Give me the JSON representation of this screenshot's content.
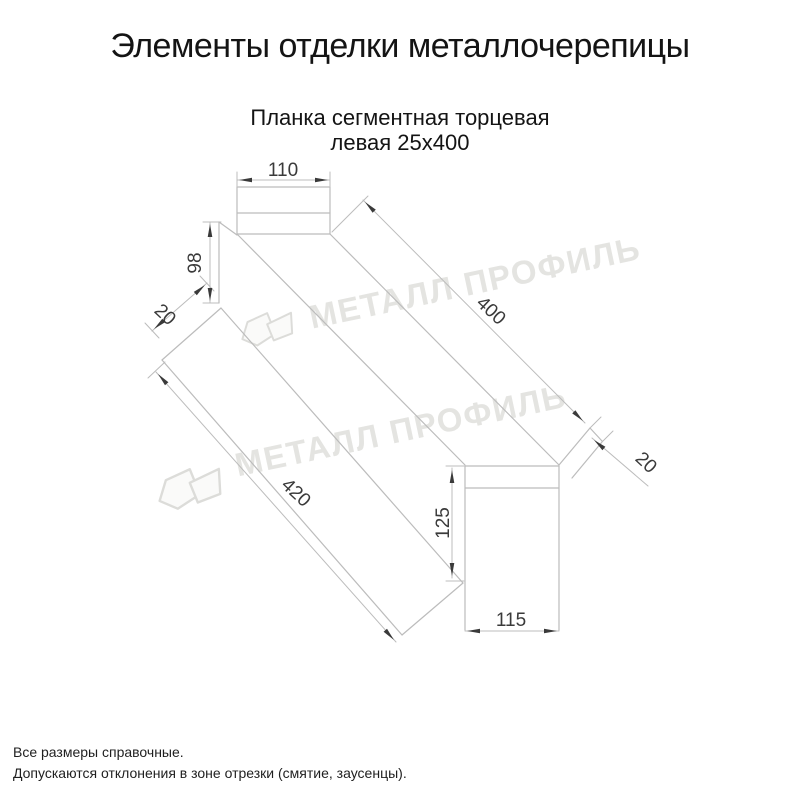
{
  "title": "Элементы отделки металлочерепицы",
  "subtitle": {
    "line1": "Планка сегментная торцевая",
    "line2": "левая 25х400"
  },
  "dimensions": {
    "top_width": "110",
    "left_flange_height": "98",
    "left_hem": "20",
    "length": "400",
    "right_hem": "20",
    "bottom_length": "420",
    "end_height": "125",
    "end_width": "115"
  },
  "watermark": {
    "text": "МЕТАЛЛ ПРОФИЛЬ"
  },
  "footer": {
    "line1": "Все размеры справочные.",
    "line2": "Допускаются отклонения в зоне отрезки (смятие, заусенцы)."
  },
  "colors": {
    "background": "#ffffff",
    "outline_line": "#bcbcbc",
    "dimension_marks": "#3a3a3a",
    "text": "#141414",
    "watermark": "#e4e4e1"
  }
}
